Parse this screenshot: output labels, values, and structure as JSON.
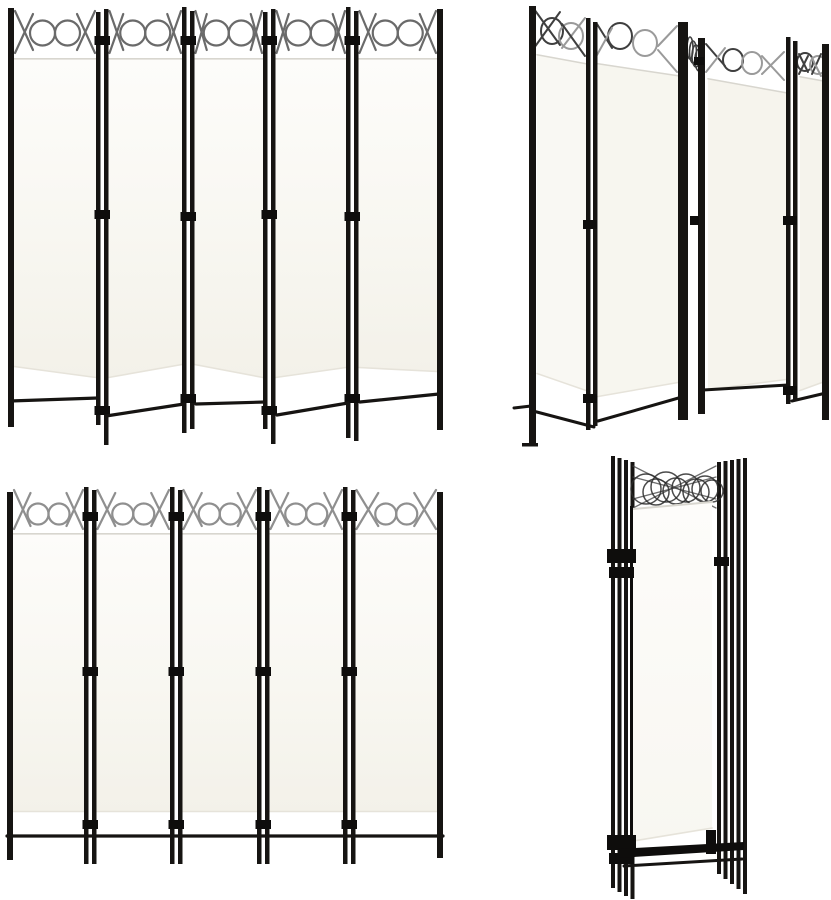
{
  "scene": {
    "background": "#ffffff",
    "subject": "5-panel-folding-room-divider-white",
    "views": [
      {
        "id": "view-front-zigzag",
        "panels": 5
      },
      {
        "id": "view-angled",
        "panels": 5
      },
      {
        "id": "view-front-flat",
        "panels": 5
      },
      {
        "id": "view-folded-stack",
        "panels": 5
      }
    ]
  },
  "colors": {
    "background": "#ffffff",
    "frame": "#161412",
    "frame_deep": "#0e0d0c",
    "wire_front": "#6a6a6a",
    "wire_flat": "#8f8f8f",
    "wire_dark": "#3f3f3f",
    "wire_light": "#9a9a9a",
    "ring_folded": "#2b2b2b",
    "fabric_top": "#fdfcfa",
    "fabric_mid": "#f8f7f1",
    "fabric_low": "#f3f1e9",
    "fabric_edge": "#d8d6cf",
    "fabric_hem": "#e6e3da",
    "angled_p1": "#f9f8f3",
    "angled_p2": "#f7f6ef",
    "angled_p3": "#f6f4ed",
    "angled_p4": "#f5f3ec"
  }
}
